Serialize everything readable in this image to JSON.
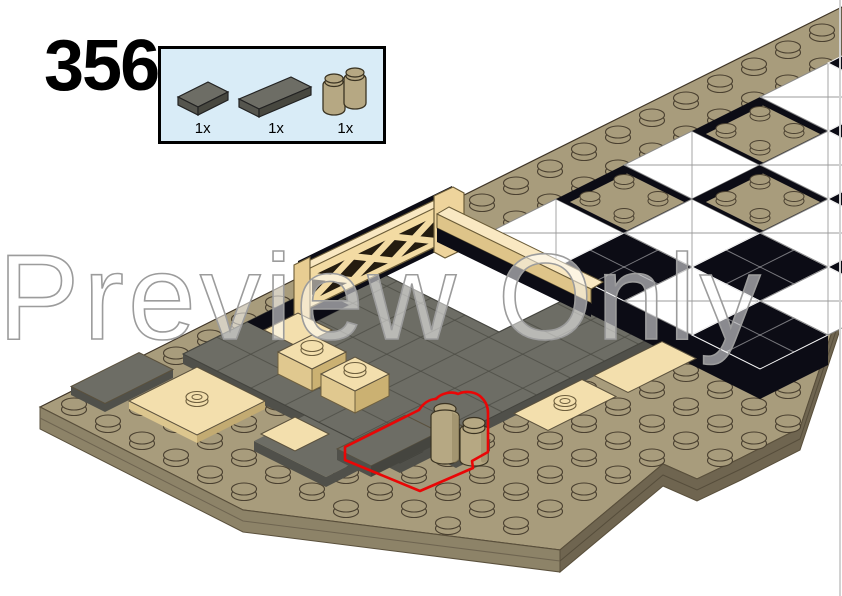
{
  "step": {
    "number": "356"
  },
  "parts_box": {
    "background": "#d9ecf7",
    "border_color": "#000000",
    "parts": [
      {
        "icon": "tile-1x2-dark-gray-icon",
        "count": "1x"
      },
      {
        "icon": "tile-1x3-dark-gray-icon",
        "count": "1x"
      },
      {
        "icon": "brick-1x2-log-dark-tan-icon",
        "count": "1x"
      }
    ]
  },
  "watermark": {
    "text": "Preview Only"
  },
  "illustration": {
    "description": "Isometric LEGO build: tan studded baseplate, dark gray tiled floor with tan accents, black and white checkerboard floor, tan lattice fence wall, new parts highlighted with red outline",
    "highlight_color": "#e90606"
  },
  "colors": {
    "page_bg": "#ffffff",
    "box_bg": "#d9ecf7",
    "plate": "#a89c7c",
    "plate_side": "#8d8368",
    "plate_side_dark": "#6f6550",
    "gray": "#6d6d65",
    "gray_side": "#50504a",
    "tan": "#f3dfad",
    "tan_side": "#dcc68e",
    "tan_dark": "#c3ab72",
    "dark_tan": "#b6a883",
    "dark_tan_side": "#9b8d68",
    "black": "#0c0c15",
    "white": "#ffffff",
    "fence": "#f3dba3",
    "fence_top": "#f9e8c2",
    "fence_dark": "#241c10",
    "red": "#e90606",
    "watermark_stroke": "#9c9c9c"
  }
}
